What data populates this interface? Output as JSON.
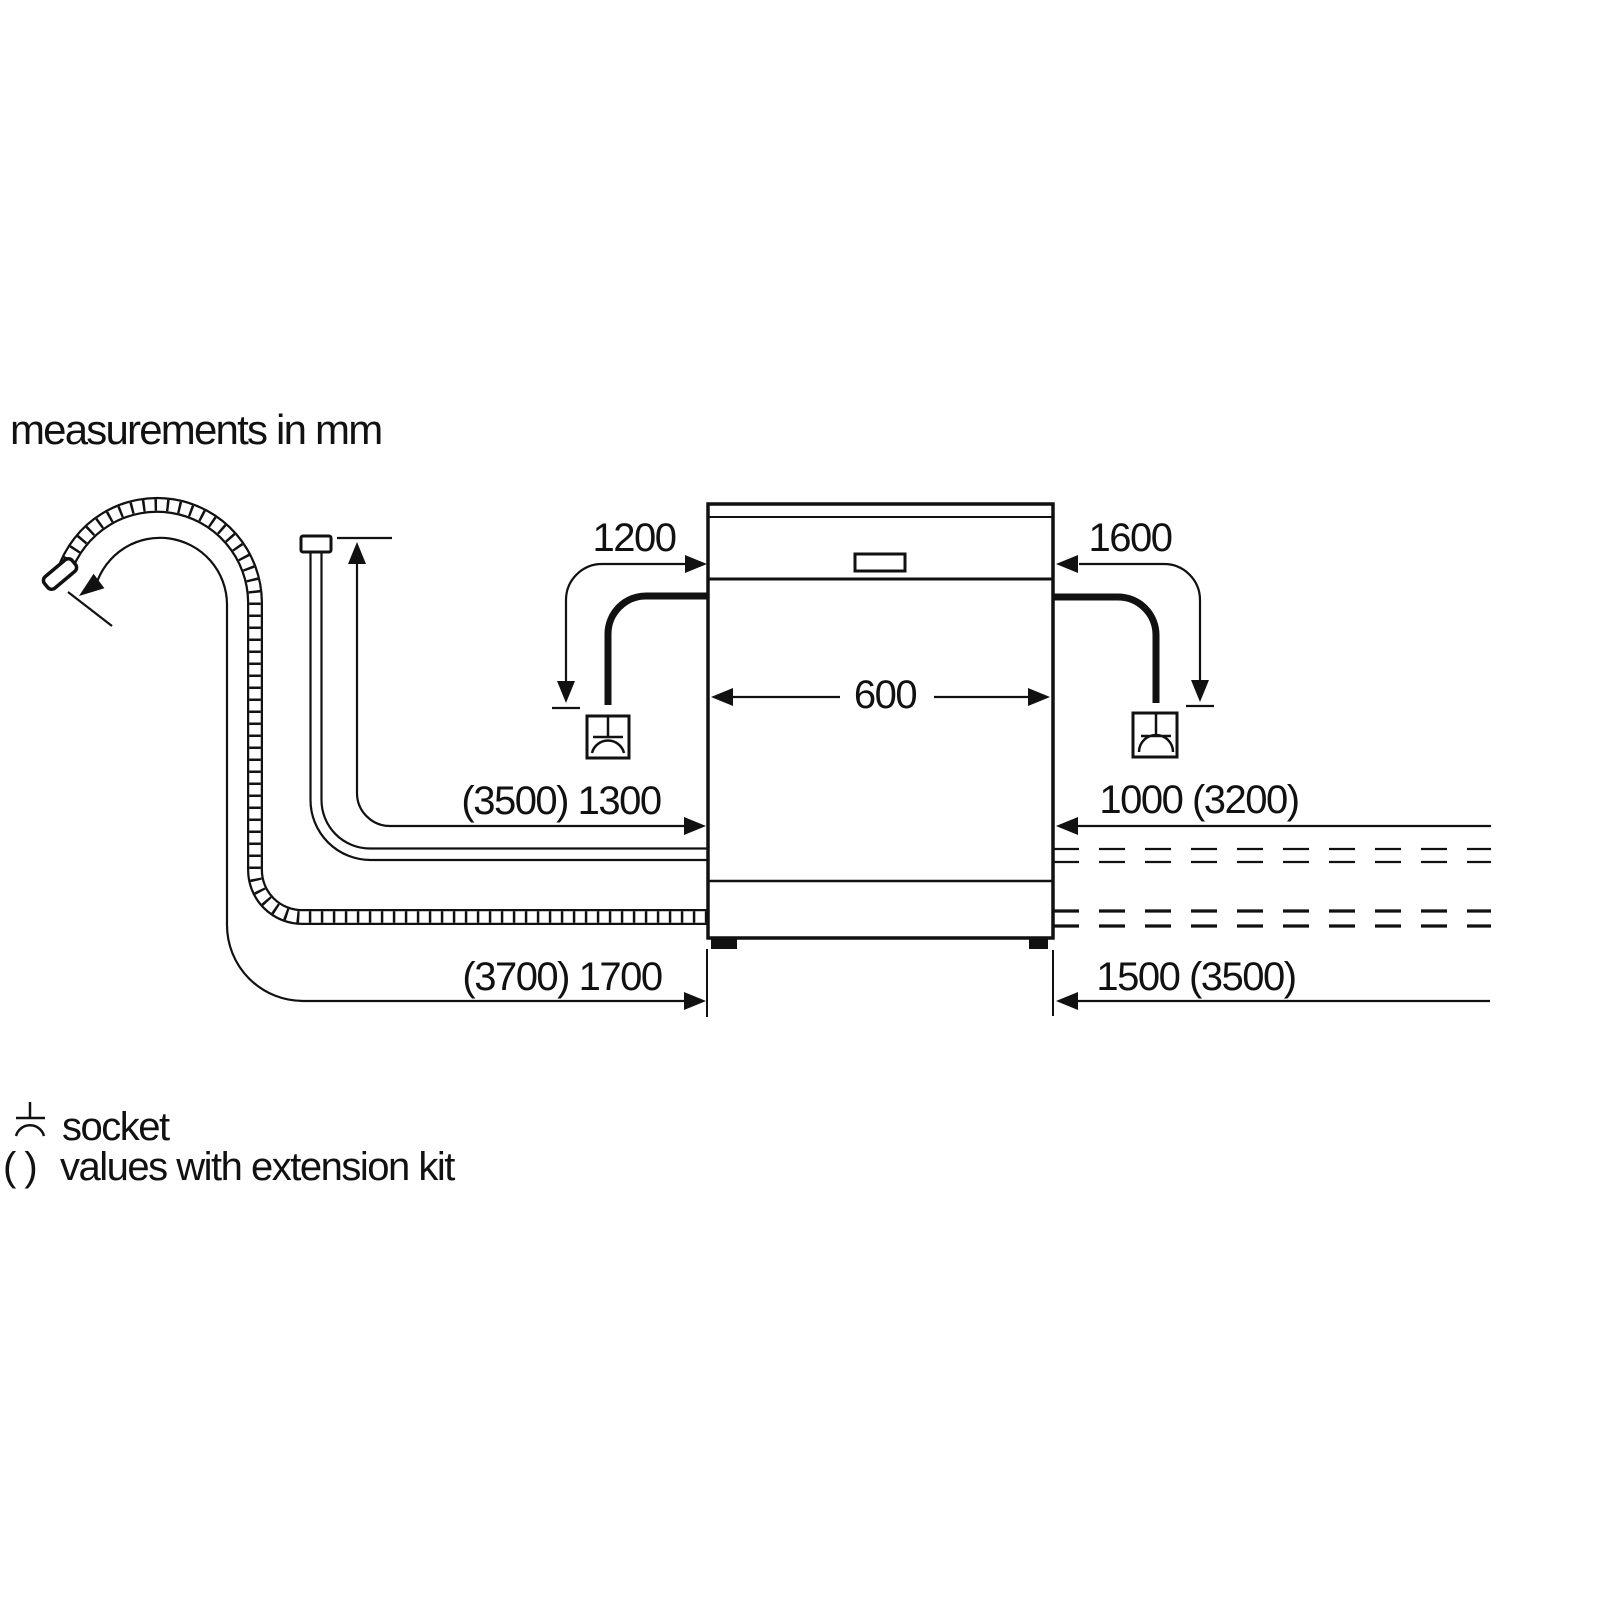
{
  "title": "measurements in mm",
  "dishwasher": {
    "width_label": "600"
  },
  "left": {
    "cord_length_label": "1200",
    "supply_hose_label": "(3500) 1300",
    "drain_hose_label": "(3700) 1700"
  },
  "right": {
    "cord_length_label": "1600",
    "supply_hose_label": "1000 (3200)",
    "drain_hose_label": "1500 (3500)"
  },
  "legend": {
    "socket_label": "socket",
    "extension_prefix": "( )",
    "extension_label": "values with extension kit"
  },
  "colors": {
    "line": "#111111",
    "background": "#ffffff"
  }
}
